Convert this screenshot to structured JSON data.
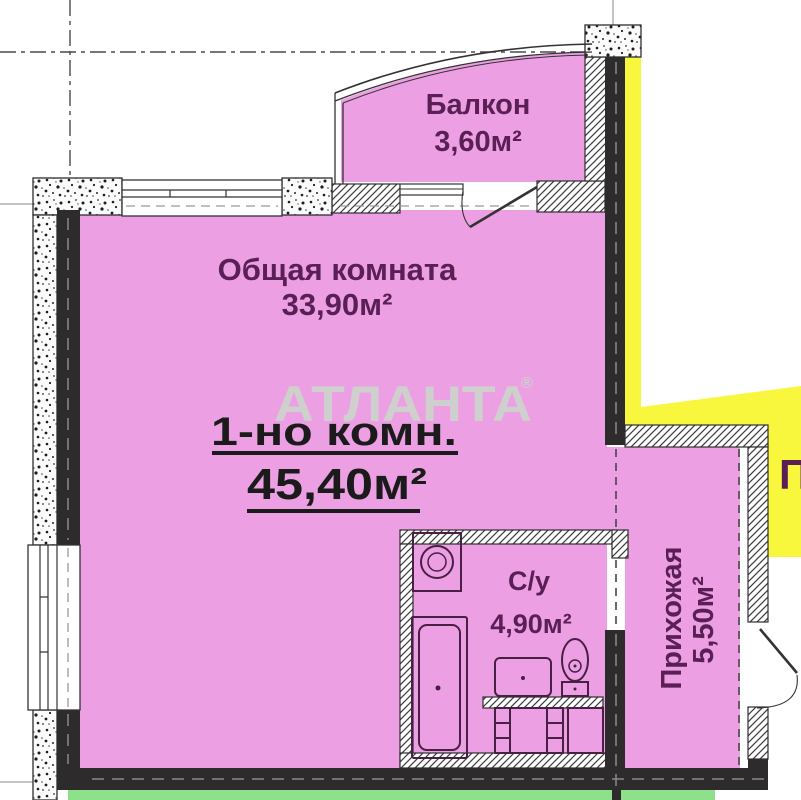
{
  "plan": {
    "watermark": {
      "brand": "АТЛАНТА",
      "registered_mark": "®"
    },
    "summary": {
      "type_label": "1-но комн.",
      "total_area": "45,40м²"
    },
    "rooms": {
      "living": {
        "name": "Общая комната",
        "area": "33,90м²"
      },
      "balcony": {
        "name": "Балкон",
        "area": "3,60м²"
      },
      "bathroom": {
        "name": "С/у",
        "area": "4,90м²"
      },
      "hallway": {
        "name": "Прихожая",
        "area": "5,50м²"
      },
      "neighbor": {
        "label": "П"
      }
    },
    "fixtures": [
      "washing-machine",
      "bathtub",
      "sink",
      "vanity-cabinet",
      "toilet"
    ],
    "colors": {
      "room_fill": "#ec9fe2",
      "neighbor_fill": "#f8f73e",
      "landing_fill": "#8ee08b",
      "wall_dark": "#2e2b2c",
      "label_text": "#5a1f55",
      "summary_text": "#1b1b1b",
      "watermark_text": "#cfcfce"
    }
  }
}
